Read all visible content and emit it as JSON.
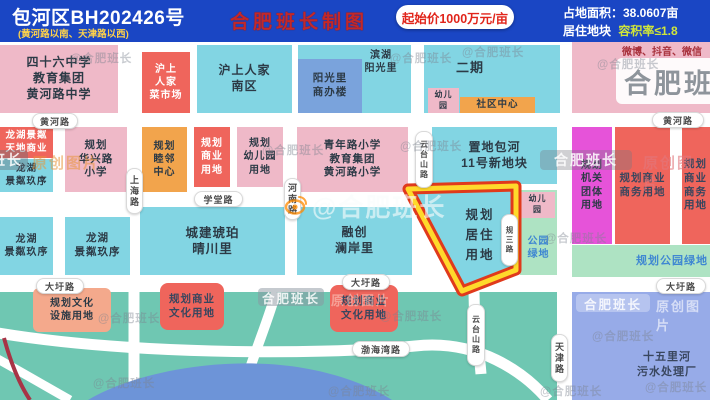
{
  "header": {
    "parcel_id": "包河区BH202426号",
    "location": "(黄河路以南、天津路以西)",
    "price": "起始价1000万元/亩",
    "area": "占地面积：38.0607亩",
    "land_type": "居住地块",
    "far": "容积率≤1.8"
  },
  "watermarks": {
    "maker_title": "合肥班长制图",
    "handle": "@合肥班长",
    "brand": "合肥班长",
    "suffix": "原创图片",
    "social": "微博、抖音、微信"
  },
  "roads": {
    "huanghe": "黄河路",
    "xuetang": "学堂路",
    "dawei": "大圩路",
    "bohaiwan": "渤海湾路",
    "shanghai": "上海路",
    "henan": "河南路",
    "yuntaishan": "云台山路",
    "tianjin": "天津路",
    "guisan": "规三路"
  },
  "parcel": {
    "label": "规划\n居住\n用地"
  },
  "blocks": [
    {
      "label": "四十六中学\n教育集团\n黄河路中学"
    },
    {
      "label": "沪上\n人家\n菜市场"
    },
    {
      "label": "沪上人家\n南区"
    },
    {
      "label": "滨湖\n阳光里"
    },
    {
      "label": "阳光里\n商办楼"
    },
    {
      "label": "二期"
    },
    {
      "label": "幼儿\n园"
    },
    {
      "label": "社区中心"
    },
    {
      "label": "龙湖景粼\n天地商业"
    },
    {
      "label": "龙湖\n景粼玖序"
    },
    {
      "label": "规划\n华兴路\n小学"
    },
    {
      "label": "规划\n睦邻\n中心"
    },
    {
      "label": "规划\n商业\n用地"
    },
    {
      "label": "规划\n幼儿园\n用地"
    },
    {
      "label": "青年路小学\n教育集团\n黄河路小学"
    },
    {
      "label": "置地包河\n11号新地块"
    },
    {
      "label": "规划\n机关\n团体\n用地"
    },
    {
      "label": "规划商业\n商务用地"
    },
    {
      "label": "规划商业\n商务用地"
    },
    {
      "label": "龙湖\n景粼玖序"
    },
    {
      "label": "龙湖\n景粼玖序"
    },
    {
      "label": "城建琥珀\n晴川里"
    },
    {
      "label": "融创\n澜岸里"
    },
    {
      "label": "公园\n绿地"
    },
    {
      "label": "幼儿\n园"
    },
    {
      "label": "规划公园绿地"
    },
    {
      "label": "规划文化\n设施用地"
    },
    {
      "label": "规划商业\n文化用地"
    },
    {
      "label": "规划商业\n文化用地"
    },
    {
      "label": "十五里河\n污水处理厂"
    }
  ],
  "colors": {
    "header_bg": "#1a46c4",
    "residential_cyan": "#82d5e3",
    "school_pink": "#efb9c8",
    "commercial_red": "#ef655c",
    "office_periwinkle": "#7aa3dc",
    "civic_orange": "#f2a44c",
    "government_magenta": "#e653d9",
    "culture_salmon": "#f4a98c",
    "park_green": "#6fc7b2",
    "green_strip": "#aee3c3",
    "utility_blue": "#97abe8",
    "parcel_outline_red": "#e03a1c",
    "parcel_outline_yellow": "#ffd92b"
  }
}
